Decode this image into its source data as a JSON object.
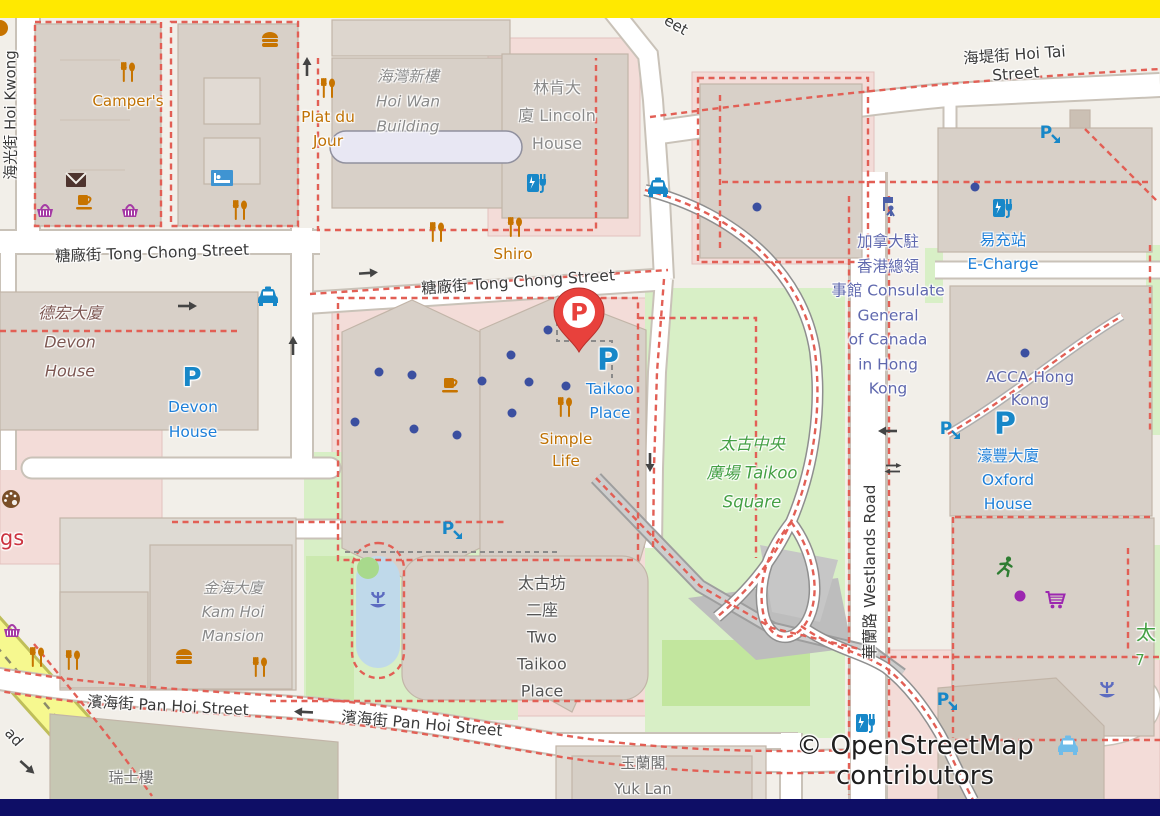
{
  "bars": {
    "top_color": "#FFE900",
    "bottom_color": "#0E0E66"
  },
  "attribution": {
    "text": "© OpenStreetMap contributors"
  },
  "icon_glyphs": {
    "parking": "P"
  },
  "marker": {
    "kind": "red-parking-pin",
    "letter": "P",
    "x": 579,
    "y": 352,
    "color": "#E8413C"
  },
  "colors": {
    "land": "#F2EFE9",
    "building": "#D8D0C8",
    "building_outline": "#C2B5A8",
    "retail_pink": "#F3DCD8",
    "park_green": "#D8EFC6",
    "bright_green": "#C2E69E",
    "pond_blue": "#BFD9EA",
    "road_white": "#FFFFFF",
    "road_casing": "#C9C2B8",
    "private_road_dash": "#E25F55",
    "yellow_road": "#F6F88F",
    "poi_orange": "#BF7103",
    "transport_blue": "#1E7FD8",
    "office_indigo": "#5F68AE",
    "leisure_green": "#44A044",
    "entrance_dot": "#3B4FA0"
  },
  "map": {
    "labels": [
      {
        "n": "street-hoi-kwong",
        "l": [
          "海光街 Hoi Kwong"
        ],
        "x": 10,
        "y": 115,
        "s": 15,
        "r": -90,
        "c": "street"
      },
      {
        "n": "street-tong-chong-west",
        "l": [
          "糖廠街 Tong Chong Street"
        ],
        "x": 152,
        "y": 252,
        "s": 15.5,
        "r": -2,
        "c": "street"
      },
      {
        "n": "street-tong-chong-center",
        "l": [
          "糖廠街 Tong Chong Street"
        ],
        "x": 518,
        "y": 281,
        "s": 15.5,
        "r": -4,
        "c": "street"
      },
      {
        "n": "street-hoi-tai",
        "l": [
          "海堤街 Hoi Tai Street"
        ],
        "x": 1015,
        "y": 63,
        "s": 15.5,
        "r": -4,
        "c": "street"
      },
      {
        "n": "street-pan-hoi-west",
        "l": [
          "濱海街 Pan Hoi Street"
        ],
        "x": 168,
        "y": 705,
        "s": 15.5,
        "r": 3,
        "c": "street"
      },
      {
        "n": "street-pan-hoi-east",
        "l": [
          "濱海街 Pan Hoi Street"
        ],
        "x": 422,
        "y": 723,
        "s": 15.5,
        "r": 5,
        "c": "street"
      },
      {
        "n": "street-westlands-road",
        "l": [
          "華蘭路 Westlands Road"
        ],
        "x": 869,
        "y": 572,
        "s": 15.5,
        "r": -90,
        "c": "street"
      },
      {
        "n": "street-fragment-eet",
        "l": [
          "eet"
        ],
        "x": 676,
        "y": 25,
        "s": 15,
        "r": 30,
        "c": "street"
      },
      {
        "n": "street-fragment-ad",
        "l": [
          "ad"
        ],
        "x": 14,
        "y": 737,
        "s": 15,
        "r": 48,
        "c": "street"
      },
      {
        "n": "building-hoi-wan",
        "l": [
          "海灣新樓",
          "Hoi Wan",
          "Building"
        ],
        "x": 408,
        "y": 102,
        "s": 15.5,
        "r": 0,
        "c": "bgray",
        "i": true,
        "lh": 25
      },
      {
        "n": "building-lincoln-house",
        "l": [
          "林肯大",
          "廈 Lincoln",
          "House"
        ],
        "x": 557,
        "y": 116,
        "s": 16,
        "r": 0,
        "c": "bgray",
        "lh": 28
      },
      {
        "n": "building-devon-house",
        "l": [
          "德宏大廈",
          "Devon",
          "House"
        ],
        "x": 70,
        "y": 342,
        "s": 16,
        "r": 0,
        "c": "maroon",
        "i": true,
        "lh": 29
      },
      {
        "n": "building-kam-hoi-mansion",
        "l": [
          "金海大廈",
          "Kam Hoi",
          "Mansion"
        ],
        "x": 233,
        "y": 612,
        "s": 15,
        "r": 0,
        "c": "bgray",
        "i": true,
        "lh": 24
      },
      {
        "n": "building-two-taikoo-place",
        "l": [
          "太古坊",
          "二座",
          "Two",
          "Taikoo",
          "Place"
        ],
        "x": 542,
        "y": 637,
        "s": 16,
        "r": 0,
        "c": "bdark",
        "lh": 27
      },
      {
        "n": "building-swiss-house",
        "l": [
          "瑞士樓"
        ],
        "x": 131,
        "y": 777,
        "s": 15,
        "r": 0,
        "c": "bgray2"
      },
      {
        "n": "building-yuk-lan",
        "l": [
          "玉蘭閣",
          "Yuk Lan"
        ],
        "x": 643,
        "y": 776,
        "s": 15,
        "r": 0,
        "c": "bgray2",
        "lh": 26
      },
      {
        "n": "poi-campers",
        "l": [
          "Camper's"
        ],
        "x": 128,
        "y": 101,
        "s": 15,
        "r": 0,
        "c": "orange"
      },
      {
        "n": "poi-plat-du-jour",
        "l": [
          "Plat du",
          "Jour"
        ],
        "x": 328,
        "y": 129,
        "s": 15.5,
        "r": 0,
        "c": "orange",
        "lh": 24
      },
      {
        "n": "poi-shiro",
        "l": [
          "Shiro"
        ],
        "x": 513,
        "y": 254,
        "s": 15.5,
        "r": 0,
        "c": "orange"
      },
      {
        "n": "poi-simple-life",
        "l": [
          "Simple",
          "Life"
        ],
        "x": 566,
        "y": 450,
        "s": 15.5,
        "r": 0,
        "c": "orange",
        "lh": 22
      },
      {
        "n": "poi-fragment-gs",
        "l": [
          "gs"
        ],
        "x": 12,
        "y": 538,
        "s": 21,
        "r": 0,
        "c": "red"
      },
      {
        "n": "parking-devon-house",
        "l": [
          "Devon",
          "House"
        ],
        "x": 193,
        "y": 420,
        "s": 15.5,
        "r": 0,
        "c": "blue",
        "lh": 25
      },
      {
        "n": "parking-taikoo-place",
        "l": [
          "Taikoo",
          "Place"
        ],
        "x": 610,
        "y": 401,
        "s": 15.5,
        "r": 0,
        "c": "blue",
        "lh": 24
      },
      {
        "n": "poi-e-charge",
        "l": [
          "易充站",
          "E-Charge"
        ],
        "x": 1003,
        "y": 252,
        "s": 15.5,
        "r": 0,
        "c": "blue",
        "lh": 24
      },
      {
        "n": "parking-oxford-house",
        "l": [
          "濠豐大廈",
          "Oxford",
          "House"
        ],
        "x": 1008,
        "y": 480,
        "s": 15.5,
        "r": 0,
        "c": "blue",
        "lh": 24
      },
      {
        "n": "poi-consulate-canada",
        "l": [
          "加拿大駐",
          "香港總領",
          "事館 Consulate",
          "General",
          "of Canada",
          "in Hong",
          "Kong"
        ],
        "x": 888,
        "y": 315,
        "s": 15.5,
        "r": 0,
        "c": "indigo",
        "lh": 24.5
      },
      {
        "n": "poi-acca-hong-kong",
        "l": [
          "ACCA Hong",
          "Kong"
        ],
        "x": 1030,
        "y": 389,
        "s": 15.5,
        "r": 0,
        "c": "indigo",
        "lh": 23
      },
      {
        "n": "park-taikoo-square",
        "l": [
          "太古中央",
          "廣場 Taikoo",
          "Square"
        ],
        "x": 752,
        "y": 473,
        "s": 16.5,
        "r": 0,
        "c": "green",
        "i": true,
        "lh": 29
      },
      {
        "n": "green-fragment-tai",
        "l": [
          "太"
        ],
        "x": 1146,
        "y": 631,
        "s": 20,
        "r": 0,
        "c": "green"
      },
      {
        "n": "green-fragment-7",
        "l": [
          "7"
        ],
        "x": 1140,
        "y": 660,
        "s": 15,
        "r": 0,
        "c": "green"
      },
      {
        "n": "parking-p-taikoo",
        "l": [
          "P"
        ],
        "x": 608,
        "y": 360,
        "s": 30,
        "r": 0,
        "c": "pblue"
      },
      {
        "n": "parking-p-oxford",
        "l": [
          "P"
        ],
        "x": 1005,
        "y": 424,
        "s": 30,
        "r": 0,
        "c": "pblue"
      },
      {
        "n": "parking-p-devon",
        "l": [
          "P"
        ],
        "x": 192,
        "y": 378,
        "s": 26,
        "r": 0,
        "c": "pblue"
      }
    ],
    "icons": [
      {
        "t": "restaurant",
        "n": "restaurant-icon",
        "x": 128,
        "y": 72
      },
      {
        "t": "restaurant",
        "n": "restaurant-icon",
        "x": 240,
        "y": 210
      },
      {
        "t": "restaurant",
        "n": "restaurant-icon",
        "x": 328,
        "y": 88
      },
      {
        "t": "restaurant",
        "n": "restaurant-icon",
        "x": 437,
        "y": 232
      },
      {
        "t": "restaurant",
        "n": "restaurant-icon",
        "x": 515,
        "y": 227
      },
      {
        "t": "restaurant",
        "n": "restaurant-icon",
        "x": 565,
        "y": 407
      },
      {
        "t": "restaurant",
        "n": "restaurant-icon",
        "x": 37,
        "y": 657
      },
      {
        "t": "restaurant",
        "n": "restaurant-icon",
        "x": 73,
        "y": 660
      },
      {
        "t": "restaurant",
        "n": "restaurant-icon",
        "x": 260,
        "y": 667
      },
      {
        "t": "burger",
        "n": "fast-food-icon",
        "x": 270,
        "y": 40
      },
      {
        "t": "burger",
        "n": "fast-food-icon",
        "x": 184,
        "y": 657
      },
      {
        "t": "cafe",
        "n": "cafe-icon",
        "x": 84,
        "y": 202
      },
      {
        "t": "cafe",
        "n": "cafe-icon",
        "x": 450,
        "y": 385
      },
      {
        "t": "basket",
        "n": "supermarket-icon",
        "x": 45,
        "y": 210
      },
      {
        "t": "basket",
        "n": "supermarket-icon",
        "x": 130,
        "y": 210
      },
      {
        "t": "basket",
        "n": "supermarket-icon",
        "x": 12,
        "y": 630
      },
      {
        "t": "hotel",
        "n": "hotel-icon",
        "x": 222,
        "y": 178
      },
      {
        "t": "mail",
        "n": "post-icon",
        "x": 76,
        "y": 180
      },
      {
        "t": "taxi",
        "n": "taxi-icon",
        "x": 268,
        "y": 297,
        "c": "#1787C8"
      },
      {
        "t": "taxi",
        "n": "taxi-icon",
        "x": 658,
        "y": 188,
        "c": "#1787C8"
      },
      {
        "t": "taxi",
        "n": "taxi-icon",
        "x": 1068,
        "y": 746,
        "c": "#6FBCE9"
      },
      {
        "t": "charge",
        "n": "ev-charging-icon",
        "x": 536,
        "y": 183
      },
      {
        "t": "charge",
        "n": "ev-charging-icon",
        "x": 1002,
        "y": 208
      },
      {
        "t": "charge",
        "n": "ev-charging-icon",
        "x": 865,
        "y": 723
      },
      {
        "t": "pentrance",
        "n": "parking-entrance-icon",
        "x": 1050,
        "y": 134
      },
      {
        "t": "pentrance",
        "n": "parking-entrance-icon",
        "x": 950,
        "y": 430
      },
      {
        "t": "pentrance",
        "n": "parking-entrance-icon",
        "x": 452,
        "y": 530
      },
      {
        "t": "pentrance",
        "n": "parking-entrance-icon",
        "x": 947,
        "y": 701
      },
      {
        "t": "consulate",
        "n": "consulate-icon",
        "x": 888,
        "y": 207
      },
      {
        "t": "palette",
        "n": "art-gallery-icon",
        "x": 11,
        "y": 499
      },
      {
        "t": "fountain",
        "n": "fountain-icon",
        "x": 378,
        "y": 600
      },
      {
        "t": "fountain",
        "n": "fountain-icon",
        "x": 1107,
        "y": 690
      },
      {
        "t": "runner",
        "n": "fitness-icon",
        "x": 1005,
        "y": 567
      },
      {
        "t": "cart",
        "n": "shopping-cart-icon",
        "x": 1055,
        "y": 599
      },
      {
        "t": "pdot",
        "n": "poi-dot-purple",
        "x": 1020,
        "y": 596
      },
      {
        "t": "tree",
        "n": "tree-icon",
        "x": 368,
        "y": 568
      },
      {
        "t": "arrow",
        "n": "oneway-arrow-icon",
        "x": 187,
        "y": 306,
        "r": 0
      },
      {
        "t": "arrow",
        "n": "oneway-arrow-icon",
        "x": 368,
        "y": 273,
        "r": -4
      },
      {
        "t": "arrow",
        "n": "oneway-arrow-icon",
        "x": 304,
        "y": 712,
        "r": 183
      },
      {
        "t": "arrow",
        "n": "oneway-arrow-icon",
        "x": 888,
        "y": 431,
        "r": 180
      },
      {
        "t": "arrow",
        "n": "oneway-arrow-icon",
        "x": 307,
        "y": 67,
        "r": -90
      },
      {
        "t": "arrow",
        "n": "oneway-arrow-icon",
        "x": 293,
        "y": 346,
        "r": -90
      },
      {
        "t": "arrow",
        "n": "oneway-arrow-icon",
        "x": 650,
        "y": 462,
        "r": 90
      },
      {
        "t": "arrow",
        "n": "oneway-arrow-icon",
        "x": 27,
        "y": 767,
        "r": 42
      },
      {
        "t": "swap",
        "n": "two-way-arrow-icon",
        "x": 893,
        "y": 468,
        "r": 0
      }
    ],
    "entrance_dots": [
      [
        379,
        372
      ],
      [
        412,
        375
      ],
      [
        482,
        381
      ],
      [
        511,
        355
      ],
      [
        529,
        382
      ],
      [
        548,
        330
      ],
      [
        566,
        386
      ],
      [
        512,
        413
      ],
      [
        355,
        422
      ],
      [
        414,
        429
      ],
      [
        457,
        435
      ],
      [
        757,
        207
      ],
      [
        975,
        187
      ],
      [
        1025,
        353
      ]
    ]
  }
}
